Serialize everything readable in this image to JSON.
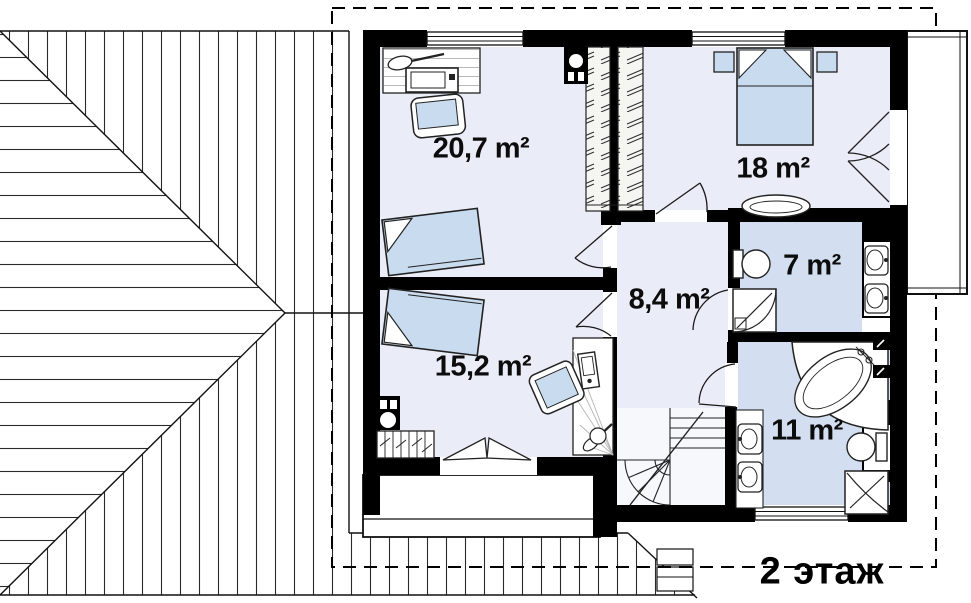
{
  "drawing": {
    "floor_label": "2 этаж",
    "rooms": [
      {
        "id": "cabinet",
        "area": "20,7 m²"
      },
      {
        "id": "bedroom",
        "area": "18 m²"
      },
      {
        "id": "hall",
        "area": "8,4 m²"
      },
      {
        "id": "bathroom-small",
        "area": "7 m²"
      },
      {
        "id": "room-lower",
        "area": "15,2 m²"
      },
      {
        "id": "bathroom-large",
        "area": "11 m²"
      }
    ],
    "colors": {
      "wall": "#000000",
      "room_fill": "#eaedf7",
      "bath_fill": "#d3dff1",
      "furniture_fill": "#c9dbee",
      "roof_line": "#2a2a2a"
    }
  }
}
